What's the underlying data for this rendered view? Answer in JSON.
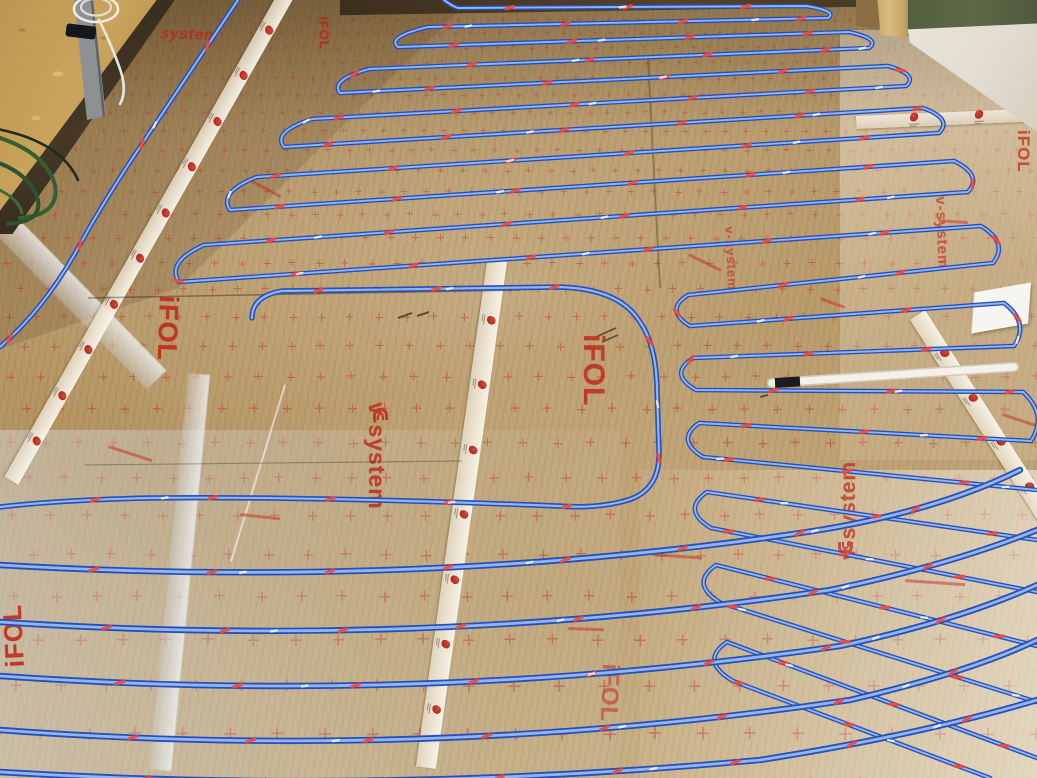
{
  "scene": {
    "type": "photograph",
    "subject": "Underfloor electric heating installation: blue heating cable laid in long serpentine loops, fixed with red clips onto reflective gold-tan insulation foil printed with a red cross grid",
    "setting": "Room under construction with an OSB wood wall at the upper left, a timber post and green fibre board at the upper right, white jointing tape seams between foil rolls, a grey conduit with a coiled white cable on the wall, green hoses at the wall base and a white sensor tube lying on the floor"
  },
  "labels": {
    "ifol": "iFOL",
    "v_system": "v-system",
    "system": "system"
  },
  "colors": {
    "cable_blue": "#2a4fb4",
    "cable_highlight": "#8fb6f4",
    "clip_red": "#ff4430",
    "foil_tan": "#b3925f",
    "grid_red": "#c03224",
    "print_red": "#bf2417",
    "tape_white": "#f2ead8",
    "osb_wood": "#c9a45c",
    "hose_green": "#33582f",
    "conduit_grey": "#8e9194",
    "wall_dark": "#463723",
    "board_green": "#5c6847",
    "post_wood": "#d9bc85",
    "floor_white": "#e3ded2",
    "tube_white": "#f4f1e8"
  },
  "objects": [
    {
      "name": "heating-cable",
      "color_ref": "cable_blue",
      "description": "blue heating cable in serpentine loops"
    },
    {
      "name": "fixing-clip",
      "color_ref": "clip_red",
      "description": "small red clips holding the cable"
    },
    {
      "name": "insulation-foil",
      "color_ref": "foil_tan",
      "description": "reflective foil with red cross grid and iFOL / v-system print"
    },
    {
      "name": "seam-tape",
      "color_ref": "tape_white",
      "description": "white joint tape with repeated red logo stamps"
    },
    {
      "name": "osb-wall",
      "color_ref": "osb_wood",
      "description": "OSB board wall, upper left"
    },
    {
      "name": "conduit-pipe",
      "color_ref": "conduit_grey",
      "description": "grey conduit with black clamp on the wall"
    },
    {
      "name": "cable-coil",
      "color_ref": "tube_white",
      "description": "coiled white cable hanging on the wall"
    },
    {
      "name": "green-hose",
      "color_ref": "hose_green",
      "description": "green hoses at the wall base"
    },
    {
      "name": "sensor-tube",
      "color_ref": "tube_white",
      "description": "white sensor conduit tube lying on the foil"
    },
    {
      "name": "timber-post",
      "color_ref": "post_wood",
      "description": "timber post, upper right"
    },
    {
      "name": "fibre-board",
      "color_ref": "board_green",
      "description": "green fibre insulation board, upper right"
    },
    {
      "name": "paper-sheet",
      "color_ref": "floor_white",
      "description": "loose white sheet on the foil, right side"
    }
  ]
}
